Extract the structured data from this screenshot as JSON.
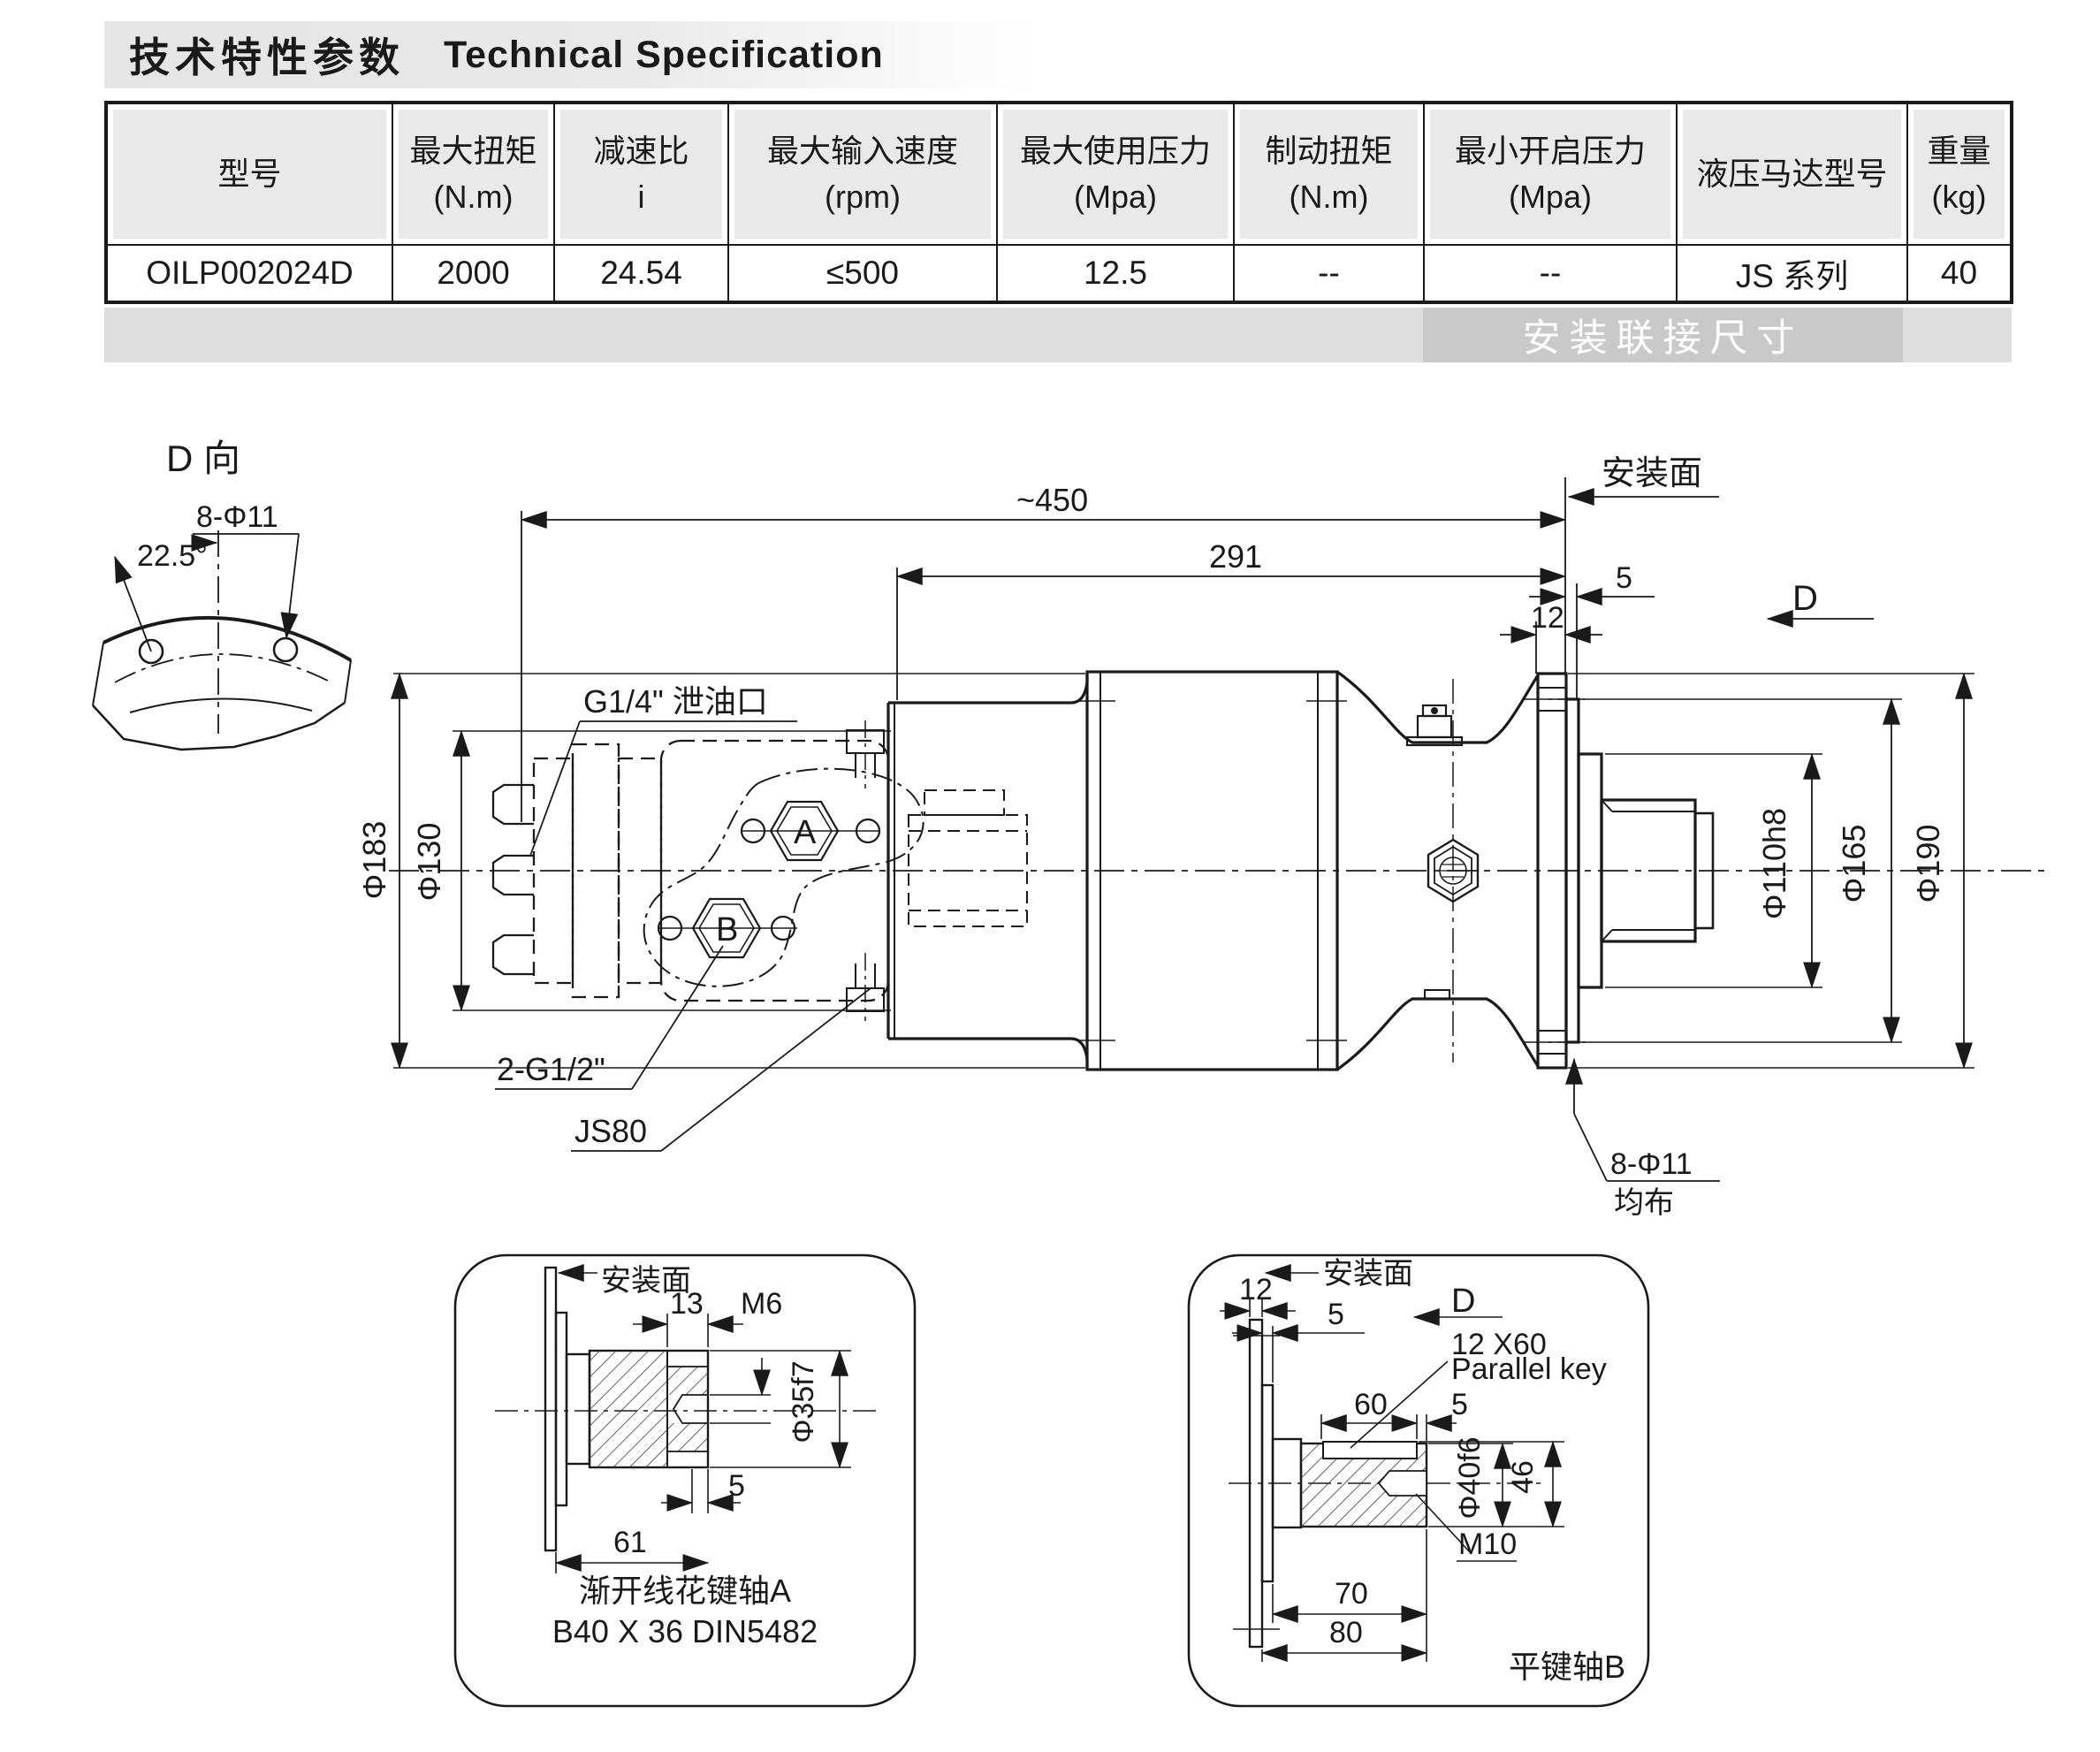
{
  "title": {
    "zh": "技术特性参数",
    "en": "Technical Specification"
  },
  "table": {
    "headers": [
      {
        "name": "型号",
        "unit": ""
      },
      {
        "name": "最大扭矩",
        "unit": "(N.m)"
      },
      {
        "name": "减速比",
        "unit": "i"
      },
      {
        "name": "最大输入速度",
        "unit": "(rpm)"
      },
      {
        "name": "最大使用压力",
        "unit": "(Mpa)"
      },
      {
        "name": "制动扭矩",
        "unit": "(N.m)"
      },
      {
        "name": "最小开启压力",
        "unit": "(Mpa)"
      },
      {
        "name": "液压马达型号",
        "unit": ""
      },
      {
        "name": "重量",
        "unit": "(kg)"
      }
    ],
    "row": {
      "model": "OILP002024D",
      "max_torque": "2000",
      "ratio": "24.54",
      "max_input_speed": "≤500",
      "max_pressure": "12.5",
      "brake_torque": "--",
      "min_opening_pressure": "--",
      "motor_model": "JS 系列",
      "weight": "40"
    }
  },
  "banner": {
    "label": "安装联接尺寸"
  },
  "colors": {
    "line": "#1a1a1a",
    "banner_light": "#dedede",
    "banner_dark": "#c9c9c9",
    "header_fill": "#e9e9e9"
  },
  "drawing": {
    "d_view": {
      "title": "D 向",
      "holes": "8-Φ11",
      "angle": "22.5°"
    },
    "main": {
      "overall_length": "~450",
      "length_291": "291",
      "mounting_face": "安装面",
      "dim_5": "5",
      "dim_12": "12",
      "view_arrow": "D",
      "dia_183": "Φ183",
      "dia_130": "Φ130",
      "drain_port": "G1/4\" 泄油口",
      "port_a": "A",
      "port_b": "B",
      "ports": "2-G1/2\"",
      "motor": "JS80",
      "dia_110": "Φ110h8",
      "dia_165": "Φ165",
      "dia_190": "Φ190",
      "flange_holes": "8-Φ11",
      "evenly_spaced": "均布"
    },
    "detail_a": {
      "mounting_face": "安装面",
      "dim_13": "13",
      "thread": "M6",
      "dia_35": "Φ35f7",
      "dim_5": "5",
      "dim_61": "61",
      "caption_line1": "渐开线花键轴A",
      "caption_line2": "B40 X 36 DIN5482"
    },
    "detail_b": {
      "dim_12": "12",
      "mounting_face": "安装面",
      "dim_5a": "5",
      "view_arrow": "D",
      "key_size": "12 X60",
      "key_label": "Parallel key",
      "dim_60": "60",
      "dim_5b": "5",
      "dia_40": "Φ40f6",
      "dim_46": "46",
      "thread": "M10",
      "dim_70": "70",
      "dim_80": "80",
      "caption": "平键轴B"
    }
  }
}
